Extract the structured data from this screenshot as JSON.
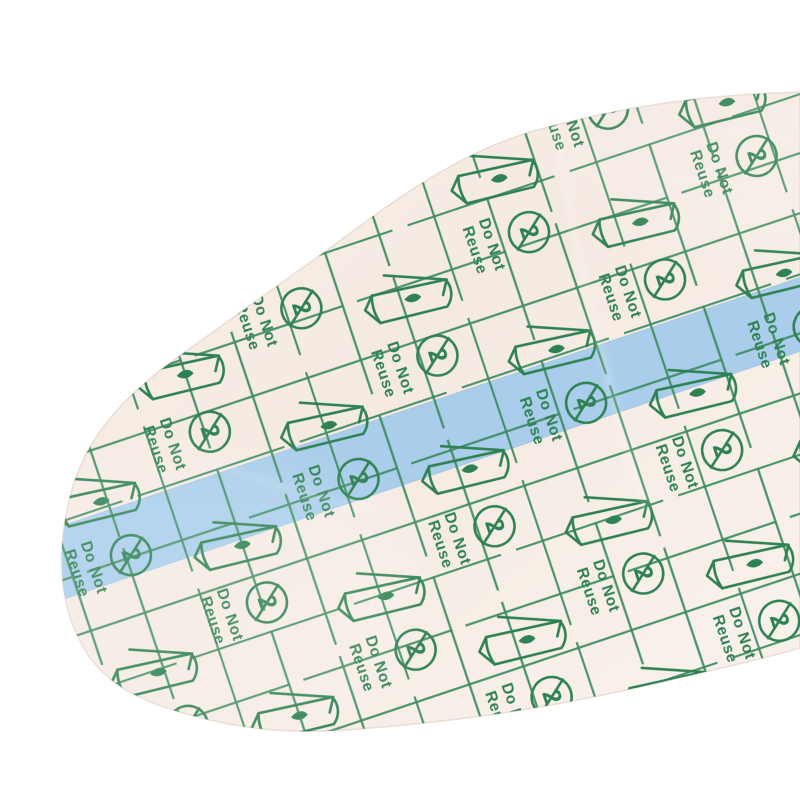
{
  "photo": {
    "background_color": "#ffffff",
    "film": {
      "paper_color": "#f6ece4",
      "paper_color_mid": "#f3e8e0",
      "paper_color_light": "#faf3ed",
      "grid_color": "#3d8b60",
      "icon_color": "#2e8152",
      "stripe_color": "#a9cdea",
      "stripe_edge_color": "#95bfe0",
      "edge_color": "#dccabf",
      "labels": {
        "line1": "Do Not",
        "line2": "Reuse",
        "symbol_numeral": "2"
      },
      "icon_names": [
        "do-not-reuse-symbol",
        "peel-pouch-icon"
      ]
    }
  }
}
